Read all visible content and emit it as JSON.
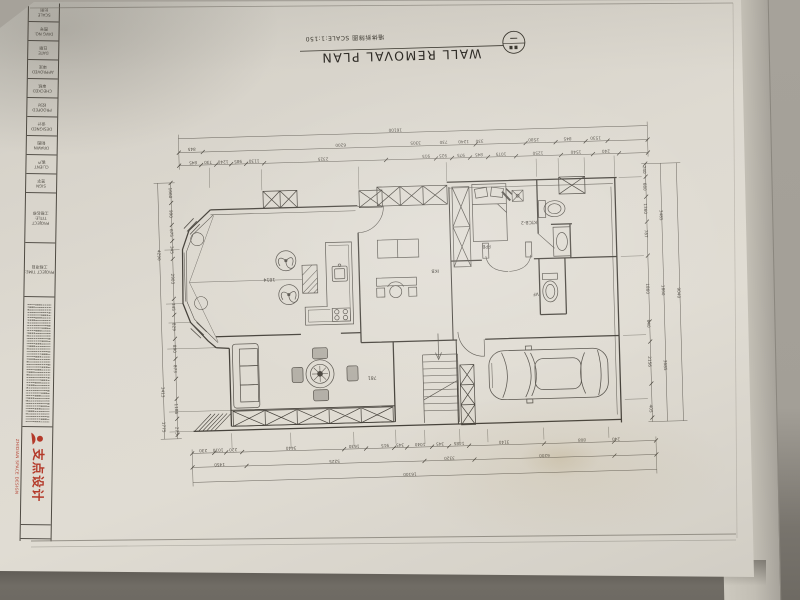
{
  "title": {
    "en": "WALL REMOVAL PLAN",
    "cn_scale": "墙体拆除图 SCALE:1:150"
  },
  "sidebar": {
    "cells": [
      {
        "en": "SCALE",
        "cn": "比例"
      },
      {
        "en": "DWG NO.",
        "cn": "图号"
      },
      {
        "en": "DATE",
        "cn": "日期"
      },
      {
        "en": "APPROVED",
        "cn": "审定"
      },
      {
        "en": "CHECKED",
        "cn": "审核"
      },
      {
        "en": "PROOFED",
        "cn": "校对"
      },
      {
        "en": "DESIGNED",
        "cn": "设计"
      },
      {
        "en": "DRAWN",
        "cn": "制图"
      },
      {
        "en": "CLIENT",
        "cn": "客户"
      },
      {
        "en": "SIGN",
        "cn": "签字"
      }
    ],
    "project_title": {
      "en": "PROJECT TITLE:",
      "cn": "工程名称"
    },
    "project_time": {
      "en": "PROJECT TIME:",
      "cn": "工程项目"
    },
    "logo": {
      "cn": "支点设计",
      "en": "ZHIDIAN SPACE DESIGN",
      "color": "#b43a2a"
    }
  },
  "room_labels": {
    "living": "1814",
    "dining": "781",
    "hall": "IKB",
    "bed": "FPB",
    "bath": "KTCB-2",
    "wc": "VF"
  },
  "dims": {
    "top1": [
      "16100"
    ],
    "top2": [
      "845",
      "6200",
      "3305",
      "730",
      "1240",
      "330",
      "2580",
      "845",
      "1530"
    ],
    "top3": [
      "845",
      "730",
      "1240",
      "985",
      "1130",
      "2325",
      "915",
      "925",
      "975",
      "845",
      "1075",
      "1250",
      "1540",
      "240"
    ],
    "bottom1": [
      "230",
      "1010",
      "220",
      "3440",
      "1630",
      "915",
      "345",
      "1040",
      "345",
      "1485",
      "3140",
      "808",
      "240"
    ],
    "bottom2": [
      "1450",
      "5225",
      "3320",
      "6200"
    ],
    "bottom3": [
      "16100"
    ],
    "right1": [
      "240",
      "680",
      "1360",
      "787",
      "1860",
      "640",
      "2156",
      "405"
    ],
    "right2": [
      "3485",
      "1860",
      "3685"
    ],
    "right3": [
      "9040"
    ],
    "left1": [
      "1660",
      "990",
      "675",
      "345",
      "2903",
      "345",
      "829",
      "890",
      "873",
      "1186",
      "275"
    ],
    "left2": [
      "4290",
      "3413",
      "1775"
    ]
  }
}
